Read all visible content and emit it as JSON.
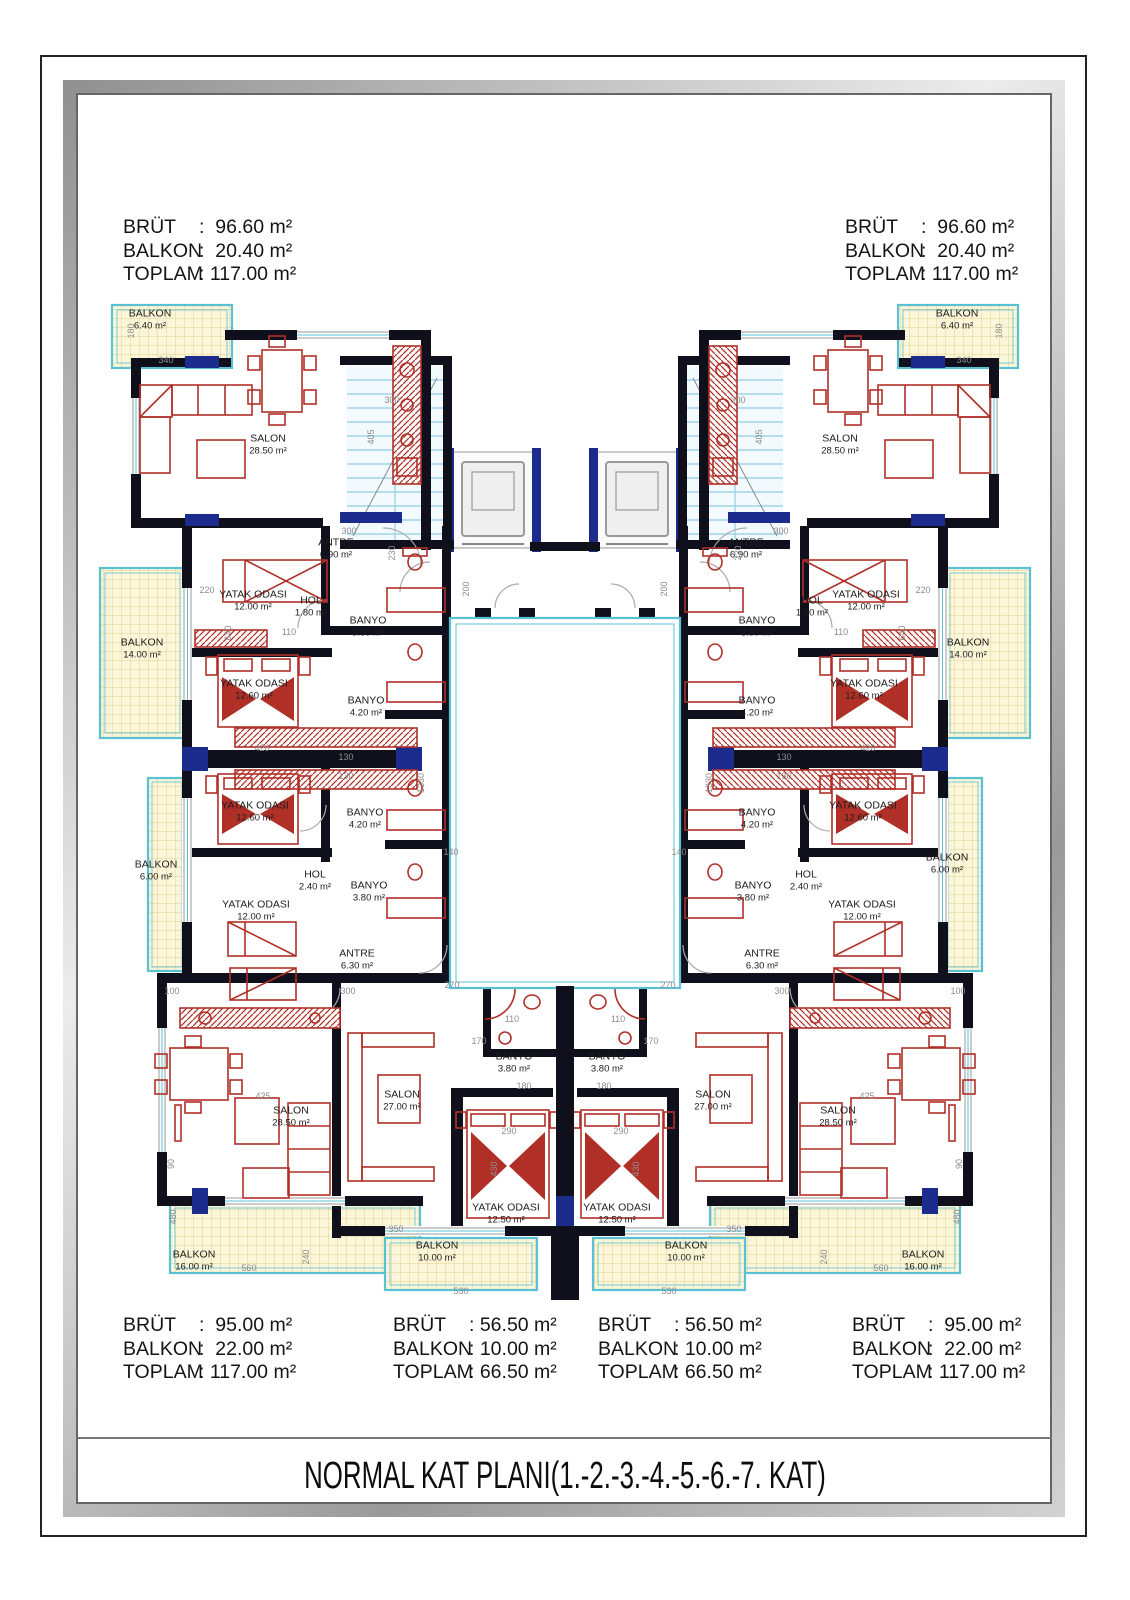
{
  "title": "NORMAL KAT PLANI(1.-2.-3.-4.-5.-6.-7. KAT)",
  "area_tables": [
    {
      "position": "top-left",
      "rows": [
        {
          "label": "BRÜT",
          "value": ":  96.60 m²"
        },
        {
          "label": "BALKON",
          "value": ":  20.40 m²"
        },
        {
          "label": "TOPLAM",
          "value": ": 117.00 m²"
        }
      ]
    },
    {
      "position": "top-right",
      "rows": [
        {
          "label": "BRÜT",
          "value": ":  96.60 m²"
        },
        {
          "label": "BALKON",
          "value": ":  20.40 m²"
        },
        {
          "label": "TOPLAM",
          "value": ": 117.00 m²"
        }
      ]
    },
    {
      "position": "bottom-left",
      "rows": [
        {
          "label": "BRÜT",
          "value": ":  95.00 m²"
        },
        {
          "label": "BALKON",
          "value": ":  22.00 m²"
        },
        {
          "label": "TOPLAM",
          "value": ": 117.00 m²"
        }
      ]
    },
    {
      "position": "bottom-center-left",
      "rows": [
        {
          "label": "BRÜT",
          "value": ": 56.50 m²"
        },
        {
          "label": "BALKON",
          "value": ": 10.00 m²"
        },
        {
          "label": "TOPLAM",
          "value": ": 66.50 m²"
        }
      ]
    },
    {
      "position": "bottom-center-right",
      "rows": [
        {
          "label": "BRÜT",
          "value": ": 56.50 m²"
        },
        {
          "label": "BALKON",
          "value": ": 10.00 m²"
        },
        {
          "label": "TOPLAM",
          "value": ": 66.50 m²"
        }
      ]
    },
    {
      "position": "bottom-right",
      "rows": [
        {
          "label": "BRÜT",
          "value": ":  95.00 m²"
        },
        {
          "label": "BALKON",
          "value": ":  22.00 m²"
        },
        {
          "label": "TOPLAM",
          "value": ": 117.00 m²"
        }
      ]
    }
  ],
  "room_labels": [
    {
      "name": "BALKON",
      "area": "6.40 m²",
      "x": 150,
      "y": 320
    },
    {
      "name": "SALON",
      "area": "28.50 m²",
      "x": 268,
      "y": 445
    },
    {
      "name": "ANTRE",
      "area": "6.90 m²",
      "x": 336,
      "y": 549
    },
    {
      "name": "YATAK ODASI",
      "area": "12.00 m²",
      "x": 253,
      "y": 601
    },
    {
      "name": "HOL",
      "area": "1.80 m²",
      "x": 311,
      "y": 607
    },
    {
      "name": "BANYO",
      "area": "3.80 m²",
      "x": 368,
      "y": 627
    },
    {
      "name": "BALKON",
      "area": "14.00 m²",
      "x": 142,
      "y": 649
    },
    {
      "name": "YATAK ODASI",
      "area": "12.60 m²",
      "x": 254,
      "y": 690
    },
    {
      "name": "BANYO",
      "area": "4.20 m²",
      "x": 366,
      "y": 707
    },
    {
      "name": "YATAK ODASI",
      "area": "12.60 m²",
      "x": 255,
      "y": 812
    },
    {
      "name": "BANYO",
      "area": "4.20 m²",
      "x": 365,
      "y": 819
    },
    {
      "name": "BALKON",
      "area": "6.00 m²",
      "x": 156,
      "y": 871
    },
    {
      "name": "HOL",
      "area": "2.40 m²",
      "x": 315,
      "y": 881
    },
    {
      "name": "BANYO",
      "area": "3.80 m²",
      "x": 369,
      "y": 892
    },
    {
      "name": "YATAK ODASI",
      "area": "12.00 m²",
      "x": 256,
      "y": 911
    },
    {
      "name": "ANTRE",
      "area": "6.30 m²",
      "x": 357,
      "y": 960
    },
    {
      "name": "SALON",
      "area": "28.50 m²",
      "x": 291,
      "y": 1117
    },
    {
      "name": "SALON",
      "area": "27.00 m²",
      "x": 402,
      "y": 1101
    },
    {
      "name": "BANYO",
      "area": "3.80 m²",
      "x": 514,
      "y": 1063
    },
    {
      "name": "YATAK ODASI",
      "area": "12.50 m²",
      "x": 506,
      "y": 1214
    },
    {
      "name": "BALKON",
      "area": "16.00 m²",
      "x": 194,
      "y": 1261
    },
    {
      "name": "BALKON",
      "area": "10.00 m²",
      "x": 437,
      "y": 1252
    },
    {
      "name": "BALKON",
      "area": "6.40 m²",
      "x": 957,
      "y": 320
    },
    {
      "name": "SALON",
      "area": "28.50 m²",
      "x": 840,
      "y": 445
    },
    {
      "name": "ANTRE",
      "area": "6.90 m²",
      "x": 746,
      "y": 549
    },
    {
      "name": "YATAK ODASI",
      "area": "12.00 m²",
      "x": 866,
      "y": 601
    },
    {
      "name": "HOL",
      "area": "1.80 m²",
      "x": 812,
      "y": 607
    },
    {
      "name": "BANYO",
      "area": "3.80 m²",
      "x": 757,
      "y": 627
    },
    {
      "name": "BALKON",
      "area": "14.00 m²",
      "x": 968,
      "y": 649
    },
    {
      "name": "YATAK ODASI",
      "area": "12.60 m²",
      "x": 864,
      "y": 690
    },
    {
      "name": "BANYO",
      "area": "4.20 m²",
      "x": 757,
      "y": 707
    },
    {
      "name": "YATAK ODASI",
      "area": "12.60 m²",
      "x": 863,
      "y": 812
    },
    {
      "name": "BANYO",
      "area": "4.20 m²",
      "x": 757,
      "y": 819
    },
    {
      "name": "BALKON",
      "area": "6.00 m²",
      "x": 947,
      "y": 864
    },
    {
      "name": "HOL",
      "area": "2.40 m²",
      "x": 806,
      "y": 881
    },
    {
      "name": "BANYO",
      "area": "3.80 m²",
      "x": 753,
      "y": 892
    },
    {
      "name": "YATAK ODASI",
      "area": "12.00 m²",
      "x": 862,
      "y": 911
    },
    {
      "name": "ANTRE",
      "area": "6.30 m²",
      "x": 762,
      "y": 960
    },
    {
      "name": "SALON",
      "area": "28.50 m²",
      "x": 838,
      "y": 1117
    },
    {
      "name": "SALON",
      "area": "27.00 m²",
      "x": 713,
      "y": 1101
    },
    {
      "name": "BANYO",
      "area": "3.80 m²",
      "x": 607,
      "y": 1063
    },
    {
      "name": "YATAK ODASI",
      "area": "12.50 m²",
      "x": 617,
      "y": 1214
    },
    {
      "name": "BALKON",
      "area": "16.00 m²",
      "x": 923,
      "y": 1261
    },
    {
      "name": "BALKON",
      "area": "10.00 m²",
      "x": 686,
      "y": 1252
    }
  ],
  "dimensions": [
    {
      "v": "340",
      "x": 166,
      "y": 360,
      "r": 0
    },
    {
      "v": "340",
      "x": 964,
      "y": 360,
      "r": 0
    },
    {
      "v": "180",
      "x": 131,
      "y": 331,
      "r": 1
    },
    {
      "v": "180",
      "x": 999,
      "y": 331,
      "r": 1
    },
    {
      "v": "405",
      "x": 371,
      "y": 437,
      "r": 1
    },
    {
      "v": "405",
      "x": 759,
      "y": 437,
      "r": 1
    },
    {
      "v": "300",
      "x": 392,
      "y": 400,
      "r": 0
    },
    {
      "v": "300",
      "x": 738,
      "y": 400,
      "r": 0
    },
    {
      "v": "300",
      "x": 349,
      "y": 531,
      "r": 0
    },
    {
      "v": "300",
      "x": 781,
      "y": 531,
      "r": 0
    },
    {
      "v": "230",
      "x": 392,
      "y": 553,
      "r": 1
    },
    {
      "v": "230",
      "x": 738,
      "y": 553,
      "r": 1
    },
    {
      "v": "220",
      "x": 207,
      "y": 590,
      "r": 0
    },
    {
      "v": "220",
      "x": 923,
      "y": 590,
      "r": 0
    },
    {
      "v": "640",
      "x": 228,
      "y": 633,
      "r": 1
    },
    {
      "v": "640",
      "x": 902,
      "y": 633,
      "r": 1
    },
    {
      "v": "110",
      "x": 289,
      "y": 632,
      "r": 0
    },
    {
      "v": "110",
      "x": 841,
      "y": 632,
      "r": 0
    },
    {
      "v": "200",
      "x": 466,
      "y": 589,
      "r": 1
    },
    {
      "v": "200",
      "x": 664,
      "y": 589,
      "r": 1
    },
    {
      "v": "130",
      "x": 346,
      "y": 757,
      "r": 0
    },
    {
      "v": "130",
      "x": 784,
      "y": 757,
      "r": 0
    },
    {
      "v": "130",
      "x": 346,
      "y": 776,
      "r": 0
    },
    {
      "v": "130",
      "x": 784,
      "y": 776,
      "r": 0
    },
    {
      "v": "420",
      "x": 262,
      "y": 748,
      "r": 0
    },
    {
      "v": "420",
      "x": 868,
      "y": 748,
      "r": 0
    },
    {
      "v": "1330",
      "x": 421,
      "y": 783,
      "r": 1
    },
    {
      "v": "1330",
      "x": 709,
      "y": 783,
      "r": 1
    },
    {
      "v": "140",
      "x": 451,
      "y": 852,
      "r": 0
    },
    {
      "v": "140",
      "x": 679,
      "y": 852,
      "r": 0
    },
    {
      "v": "100",
      "x": 172,
      "y": 991,
      "r": 0
    },
    {
      "v": "100",
      "x": 958,
      "y": 991,
      "r": 0
    },
    {
      "v": "300",
      "x": 348,
      "y": 991,
      "r": 0
    },
    {
      "v": "300",
      "x": 782,
      "y": 991,
      "r": 0
    },
    {
      "v": "270",
      "x": 452,
      "y": 985,
      "r": 0
    },
    {
      "v": "270",
      "x": 668,
      "y": 985,
      "r": 0
    },
    {
      "v": "110",
      "x": 512,
      "y": 1019,
      "r": 0
    },
    {
      "v": "110",
      "x": 618,
      "y": 1019,
      "r": 0
    },
    {
      "v": "170",
      "x": 479,
      "y": 1041,
      "r": 0
    },
    {
      "v": "170",
      "x": 651,
      "y": 1041,
      "r": 0
    },
    {
      "v": "180",
      "x": 524,
      "y": 1086,
      "r": 0
    },
    {
      "v": "180",
      "x": 604,
      "y": 1086,
      "r": 0
    },
    {
      "v": "425",
      "x": 263,
      "y": 1096,
      "r": 0
    },
    {
      "v": "425",
      "x": 867,
      "y": 1096,
      "r": 0
    },
    {
      "v": "290",
      "x": 509,
      "y": 1131,
      "r": 0
    },
    {
      "v": "290",
      "x": 621,
      "y": 1131,
      "r": 0
    },
    {
      "v": "430",
      "x": 494,
      "y": 1169,
      "r": 1
    },
    {
      "v": "430",
      "x": 636,
      "y": 1169,
      "r": 1
    },
    {
      "v": "90",
      "x": 171,
      "y": 1164,
      "r": 1
    },
    {
      "v": "90",
      "x": 959,
      "y": 1164,
      "r": 1
    },
    {
      "v": "480",
      "x": 173,
      "y": 1217,
      "r": 1
    },
    {
      "v": "480",
      "x": 957,
      "y": 1217,
      "r": 1
    },
    {
      "v": "350",
      "x": 396,
      "y": 1229,
      "r": 0
    },
    {
      "v": "350",
      "x": 734,
      "y": 1229,
      "r": 0
    },
    {
      "v": "240",
      "x": 306,
      "y": 1257,
      "r": 1
    },
    {
      "v": "240",
      "x": 824,
      "y": 1257,
      "r": 1
    },
    {
      "v": "560",
      "x": 249,
      "y": 1268,
      "r": 0
    },
    {
      "v": "560",
      "x": 881,
      "y": 1268,
      "r": 0
    },
    {
      "v": "530",
      "x": 461,
      "y": 1291,
      "r": 0
    },
    {
      "v": "530",
      "x": 669,
      "y": 1291,
      "r": 0
    }
  ],
  "colors": {
    "wall": "#10101c",
    "accent_navy": "#1b2c8c",
    "furniture": "#b03028",
    "balcony_fill": "#fbf6da",
    "balcony_grid": "#e0d18c",
    "water_cyan": "#5ac0d4",
    "stair_fill": "#f2fafd",
    "stair_tread": "#9fd4e6",
    "dim_text": "#8c8c8c"
  }
}
